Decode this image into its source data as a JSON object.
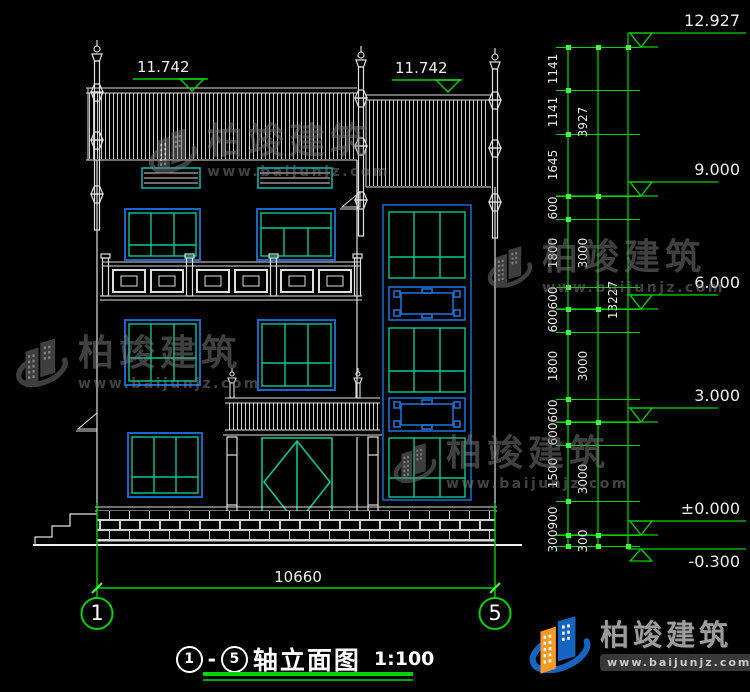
{
  "watermark": {
    "brand": "柏竣建筑",
    "url": "www.baijunjz.com"
  },
  "footer": {
    "brand": "柏竣建筑",
    "url": "www.baijunjz.com"
  },
  "drawing_title": {
    "from": "1",
    "dash": "-",
    "to": "5",
    "text": "轴立面图",
    "scale": "1:100"
  },
  "axis_bubbles": {
    "left": "1",
    "right": "5"
  },
  "bottom_dim": {
    "width": "10660"
  },
  "roof_levels": {
    "left": "11.742",
    "right": "11.742"
  },
  "levels": [
    {
      "label": "12.927",
      "y": 47
    },
    {
      "label": "9.000",
      "y": 196
    },
    {
      "label": "6.000",
      "y": 309
    },
    {
      "label": "3.000",
      "y": 422
    },
    {
      "label": "±0.000",
      "y": 535
    },
    {
      "label": "-0.300",
      "y": 546,
      "inverted": true
    }
  ],
  "dim_chain": {
    "ticks": [
      47,
      90,
      134,
      196,
      219,
      287,
      309,
      332,
      399,
      422,
      445,
      501,
      535,
      546
    ],
    "group_ticks": [
      47,
      196,
      309,
      422,
      535,
      546
    ],
    "total_ticks": [
      47,
      546
    ],
    "segments": [
      {
        "label": "1141",
        "y": 69
      },
      {
        "label": "1141",
        "y": 112
      },
      {
        "label": "1645",
        "y": 165
      },
      {
        "label": "600",
        "y": 208
      },
      {
        "label": "1800",
        "y": 253
      },
      {
        "label": "600",
        "y": 298
      },
      {
        "label": "600",
        "y": 321
      },
      {
        "label": "1800",
        "y": 366
      },
      {
        "label": "600",
        "y": 411
      },
      {
        "label": "600",
        "y": 434
      },
      {
        "label": "1500",
        "y": 473
      },
      {
        "label": "900",
        "y": 518
      },
      {
        "label": "300",
        "y": 541
      }
    ],
    "groups": [
      {
        "label": "3927",
        "y": 122
      },
      {
        "label": "3000",
        "y": 253
      },
      {
        "label": "3000",
        "y": 366
      },
      {
        "label": "3000",
        "y": 479
      },
      {
        "label": "300",
        "y": 541
      }
    ],
    "total": {
      "label": "13227",
      "y": 300
    }
  },
  "colors": {
    "cad_white": "#e8e8e8",
    "dim_green": "#00d400",
    "window_green": "#00c795",
    "frame_blue": "#1866c8",
    "louver_teal": "#00b5ad",
    "logo_orange": "#f59b25",
    "logo_blue": "#1565c0"
  }
}
